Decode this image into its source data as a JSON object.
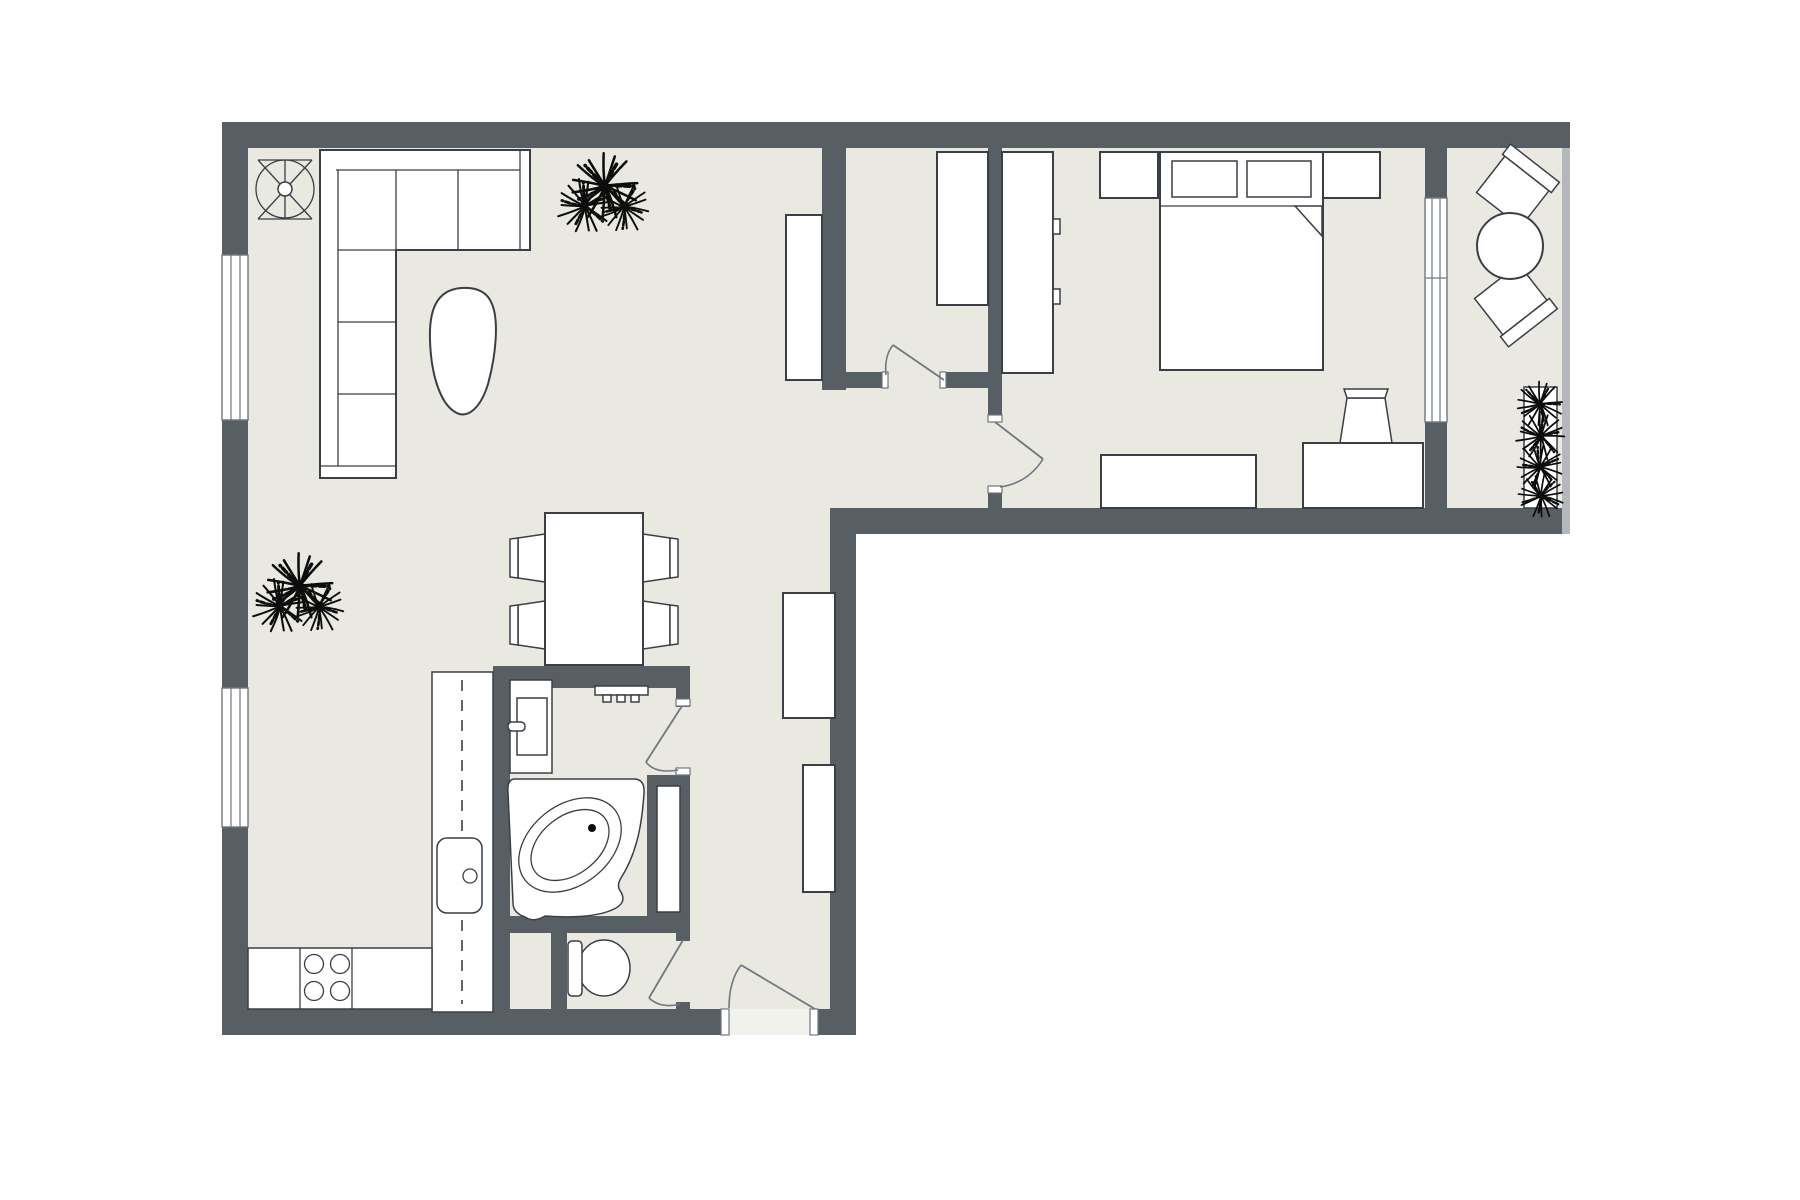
{
  "meta": {
    "title": "Apartment floor plan",
    "view": "2D top-down architectural floor plan",
    "visible_text": [],
    "style": "monochrome line drawing, dark grey walls on light beige floor, white furniture symbols"
  },
  "colors": {
    "wall": "#575e64",
    "floor": "#e9e9e1",
    "furniture_outline": "#3a3f45",
    "furniture_fill": "#ffffff",
    "door_arc": "#70777f",
    "balcony_railing": "#b4b8bc",
    "plants": "#0c0c0c",
    "background": "#ffffff"
  },
  "floorplan": {
    "room_labels": {
      "living_room": "Living room with sofa, coffee table, ceiling fan and dining area",
      "kitchen": "Open kitchen with L-shaped counter, sink and 4-burner stove",
      "closet": "Walk-in closet with wardrobe",
      "bedroom": "Bedroom with double bed, nightstands, wardrobe, dresser and desk",
      "balcony": "Balcony with round table, two chairs and planter",
      "bathroom": "Bathroom with corner tub and vanity sink",
      "wc": "Separate WC with toilet",
      "hallway": "Entry hallway with two cabinets"
    },
    "rooms": [
      {
        "id": "living_room",
        "furniture": [
          "L-shaped sectional sofa (corner chaise)",
          "organic pebble-shaped coffee table",
          "ceiling fan symbol",
          "potted plant near closet wall",
          "potted plant at left wall",
          "tall cabinet against closet wall",
          "dining table",
          "4 dining chairs"
        ]
      },
      {
        "id": "kitchen",
        "furniture": [
          "L-shaped counter with dashed worktop line",
          "kitchen sink with faucet",
          "stove with 4 burners"
        ]
      },
      {
        "id": "closet",
        "furniture": [
          "wardrobe"
        ]
      },
      {
        "id": "bedroom",
        "furniture": [
          "double bed with 2 pillows and folded blanket corner",
          "left nightstand",
          "right nightstand",
          "double-door wardrobe",
          "low dresser",
          "desk",
          "desk chair"
        ]
      },
      {
        "id": "balcony",
        "furniture": [
          "round bistro table",
          "2 angled chairs",
          "long planter box with 4 plants"
        ]
      },
      {
        "id": "bathroom",
        "furniture": [
          "corner bathtub with oval basin and drain",
          "vanity with rectangular sink and faucet",
          "towel radiator on wall"
        ]
      },
      {
        "id": "wc",
        "furniture": [
          "toilet with tank"
        ]
      },
      {
        "id": "hallway",
        "furniture": [
          "tall cabinet",
          "narrow cabinet"
        ]
      }
    ],
    "openings": {
      "windows": [
        {
          "location": "left wall upper (living room)"
        },
        {
          "location": "left wall lower (kitchen side)"
        },
        {
          "location": "bedroom-balcony sliding window with center mullion"
        }
      ],
      "doors": [
        {
          "location": "walk-in closet",
          "swing": "into closet, hinged right"
        },
        {
          "location": "bedroom",
          "swing": "into bedroom, hinged top"
        },
        {
          "location": "bathroom",
          "swing": "into bathroom, hinged top"
        },
        {
          "location": "wc",
          "swing": "into wc, hinged top"
        },
        {
          "location": "apartment entry in bottom wall",
          "swing": "into hallway, hinged right"
        }
      ]
    },
    "counts": {
      "stove_burners": 4,
      "dining_chairs": 4,
      "balcony_chairs": 2,
      "plants_freestanding": 2,
      "planter_plants": 4,
      "hallway_cabinets": 2,
      "nightstands": 2
    }
  }
}
